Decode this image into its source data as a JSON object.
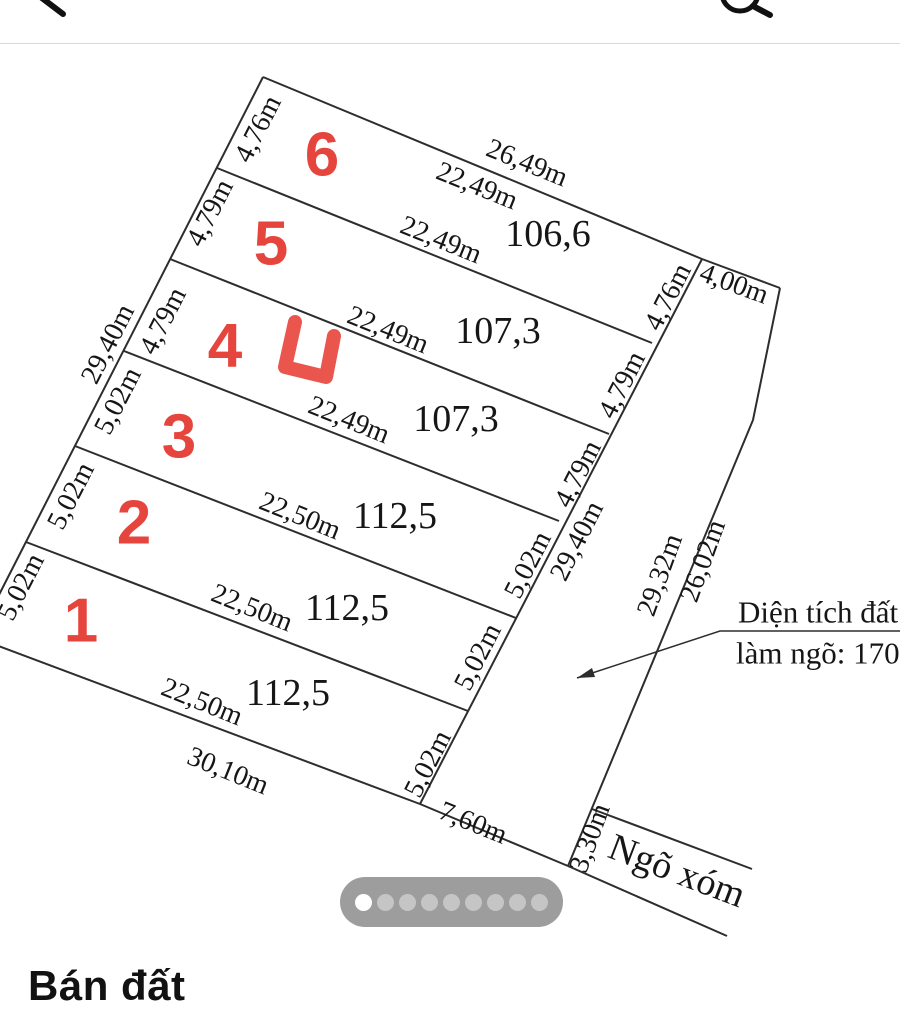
{
  "header": {
    "back_icon": "chevron-left",
    "search_icon": "magnifying-glass"
  },
  "plots": [
    {
      "number": "6",
      "area": "106,6",
      "width_left": "4,76m",
      "width_right": "4,76m"
    },
    {
      "number": "5",
      "area": "107,3",
      "width_left": "4,79m",
      "width_right": "4,79m"
    },
    {
      "number": "4",
      "area": "107,3",
      "width_left": "4,79m",
      "width_right": "4,79m"
    },
    {
      "number": "3",
      "area": "112,5",
      "width_left": "5,02m",
      "width_right": "5,02m"
    },
    {
      "number": "2",
      "area": "112,5",
      "width_left": "5,02m",
      "width_right": "5,02m"
    },
    {
      "number": "1",
      "area": "112,5",
      "width_left": "5,02m",
      "width_right": "5,02m"
    }
  ],
  "dims": {
    "top_total": "26,49m",
    "lengths": [
      "22,49m",
      "22,49m",
      "22,49m",
      "22,49m",
      "22,50m",
      "22,50m",
      "22,50m"
    ],
    "bottom_total": "30,10m",
    "left_total": "29,40m",
    "right_total": "29,40m"
  },
  "road": {
    "top": "4,00m",
    "edge_total": "29,32m",
    "edge_upper": "26,02m",
    "mouth": "3,30m",
    "frontage": "7,60m"
  },
  "note": {
    "line1": "Diện tích đất",
    "line2": "làm ngõ: 170"
  },
  "alley": {
    "label": "Ngõ xóm"
  },
  "marker": {
    "shape": "red-check-mark",
    "color": "#e5453c"
  },
  "carousel": {
    "dot_count": 9,
    "active_index": 0
  },
  "listing": {
    "title": "Bán đất"
  }
}
